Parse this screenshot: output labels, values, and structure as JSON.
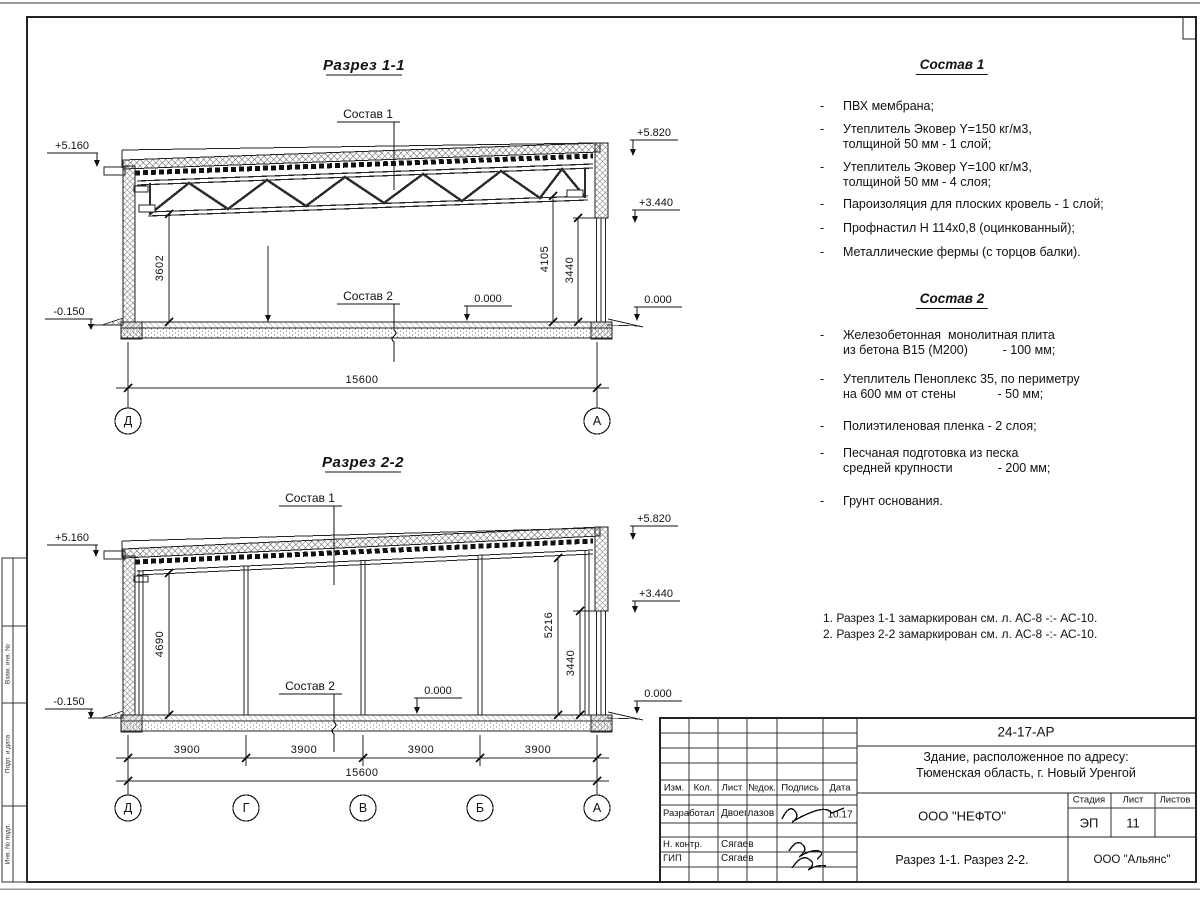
{
  "ui": {
    "dash": "-"
  },
  "margin_column": {
    "labels": [
      "Взам. инв. №",
      "Подп. и дата",
      "Инв. № подл."
    ]
  },
  "section1": {
    "title": "Разрез 1-1",
    "sostav1_label": "Состав 1",
    "sostav2_label": "Состав 2",
    "elevations": {
      "left_top": "+5.160",
      "left_bottom": "-0.150",
      "right_top": "+5.820",
      "right_mid": "+3.440",
      "right_zero": "0.000",
      "floor_zero": "0.000"
    },
    "dims": {
      "left_height": "3602",
      "right_height": "4105",
      "opening_height": "3440",
      "total_width": "15600"
    },
    "axes": [
      "Д",
      "А"
    ]
  },
  "section2": {
    "title": "Разрез 2-2",
    "sostav1_label": "Состав 1",
    "sostav2_label": "Состав 2",
    "elevations": {
      "left_top": "+5.160",
      "left_bottom": "-0.150",
      "right_top": "+5.820",
      "right_mid": "+3.440",
      "right_zero": "0.000",
      "floor_zero": "0.000"
    },
    "dims": {
      "left_height": "4690",
      "right_height": "5216",
      "opening_height": "3440",
      "spans": [
        "3900",
        "3900",
        "3900",
        "3900"
      ],
      "total_width": "15600"
    },
    "axes": [
      "Д",
      "Г",
      "В",
      "Б",
      "А"
    ]
  },
  "sostav1": {
    "title": "Состав 1",
    "items": [
      "ПВХ мембрана;",
      "Утеплитель Эковер Y=150 кг/м3,\nтолщиной 50 мм - 1 слой;",
      "Утеплитель Эковер Y=100 кг/м3,\nтолщиной 50 мм - 4 слоя;",
      "Пароизоляция для плоских кровель - 1 слой;",
      "Профнастил Н 114х0,8 (оцинкованный);",
      "Металлические фермы (с торцов балки)."
    ]
  },
  "sostav2": {
    "title": "Состав 2",
    "items": [
      "Железобетонная  монолитная плита\nиз бетона В15 (М200)          - 100 мм;",
      "Утеплитель Пеноплекс 35, по периметру\nна 600 мм от стены            - 50 мм;",
      "Полиэтиленовая пленка - 2 слоя;",
      "Песчаная подготовка из песка\nсредней крупности             - 200 мм;",
      "Грунт основания."
    ]
  },
  "notes": [
    "1. Разрез 1-1 замаркирован см. л. АС-8 -:- АС-10.",
    "2. Разрез 2-2 замаркирован см. л. АС-8 -:- АС-10."
  ],
  "titleblock": {
    "doc_code": "24-17-АР",
    "object_line1": "Здание, расположенное по адресу:",
    "object_line2": "Тюменская область, г. Новый Уренгой",
    "header_cells": [
      "Изм.",
      "Кол.",
      "Лист",
      "№док.",
      "Подпись",
      "Дата"
    ],
    "sign_rows": [
      {
        "role": "Разработал",
        "name": "Двоеглазов",
        "date": "10.17"
      },
      {
        "role": "Н. контр.",
        "name": "Сягаев",
        "date": ""
      },
      {
        "role": "ГИП",
        "name": "Сягаев",
        "date": ""
      }
    ],
    "company": "ООО \"НЕФТО\"",
    "stage_label": "Стадия",
    "sheet_label": "Лист",
    "sheets_label": "Листов",
    "stage": "ЭП",
    "sheet_number": "11",
    "sheets_total": "",
    "subject": "Разрез 1-1. Разрез 2-2.",
    "contractor": "ООО \"Альянс\""
  },
  "colors": {
    "line": "#1a1a1a",
    "sheet": "#ffffff"
  }
}
